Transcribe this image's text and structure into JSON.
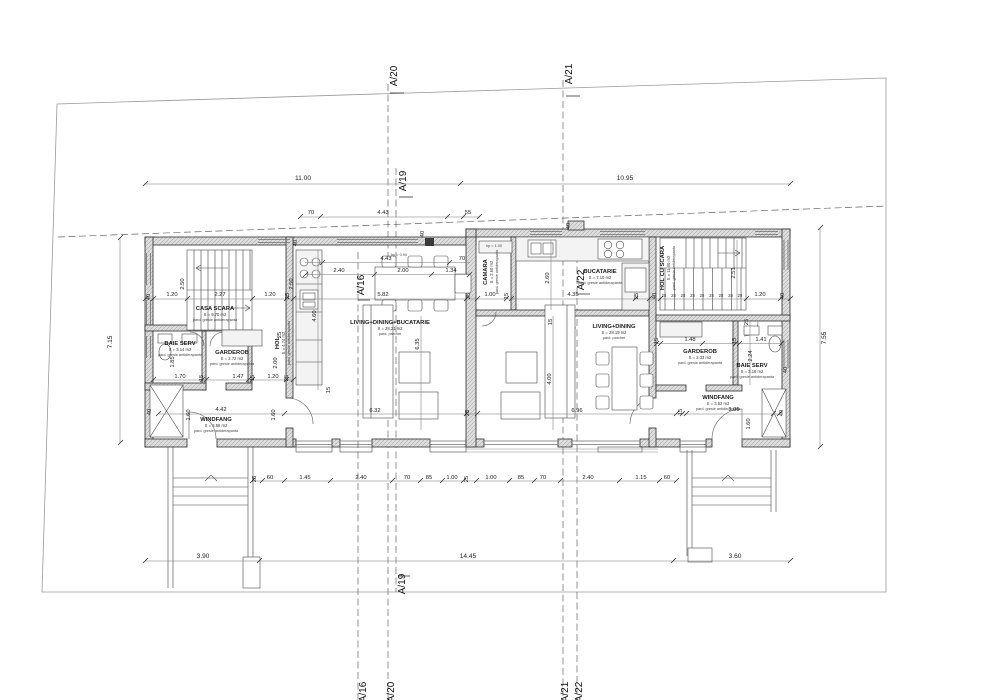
{
  "meta": {
    "drawing": "ground floor plan - duplex house"
  },
  "sections": {
    "a16": "A/16",
    "a19": "A/19",
    "a20": "A/20",
    "a21": "A/21",
    "a22": "A/22"
  },
  "rooms": {
    "casa_scara": {
      "name": "CASA SCARA",
      "area": "S = 9.70 m2",
      "finish": "pard. gresie antiderapanta"
    },
    "baie_serv_left": {
      "name": "BAIE SERV",
      "area": "S = 3.14 m2",
      "finish": "pard. gresie antiderapanta"
    },
    "garderob_left": {
      "name": "GARDEROB",
      "area": "S = 2.72 m2",
      "finish": "pard. gresie antiderapanta"
    },
    "hol_left": {
      "name": "HOL",
      "area": "S = 4.74 m2",
      "finish": "pard. gresie antiderapanta"
    },
    "windfang_left": {
      "name": "WINDFANG",
      "area": "S = 3.56 m2",
      "finish": "pard. gresie antiderapanta"
    },
    "living_left": {
      "name": "LIVING+DINING+BUCATARIE",
      "area": "S = 28.21 m2",
      "finish": "pard. parchet"
    },
    "camara": {
      "name": "CAMARA",
      "area": "S = 2.60 m2",
      "finish": "pard. gresie antiderapanta"
    },
    "bucatarie": {
      "name": "BUCATARIE",
      "area": "S = 7.10 m2",
      "finish": "pard. gresie antiderapanta"
    },
    "hol_cu_scara": {
      "name": "HOL CU SCARA",
      "area": "S = 11.00 m2",
      "finish": "pard. gresie antiderapanta"
    },
    "living_right": {
      "name": "LIVING+DINING",
      "area": "S = 28.19 m2",
      "finish": "pard. parchet"
    },
    "garderob_right": {
      "name": "GARDEROB",
      "area": "S = 2.33 m2",
      "finish": "pard. gresie antiderapanta"
    },
    "baie_serv_right": {
      "name": "BAIE SERV",
      "area": "S = 3.16 m2",
      "finish": "pard. gresie antiderapanta"
    },
    "windfang_right": {
      "name": "WINDFANG",
      "area": "S = 3.52 m2",
      "finish": "pard. gresie antiderapanta"
    }
  },
  "notes": {
    "hp090": "hp = 0.90",
    "hp100": "hp = 1.00"
  },
  "site": {
    "top_left": "11.00",
    "top_right": "10.95",
    "side_left": "7.15",
    "side_right": "7.55",
    "bottom_left": "3.90",
    "bottom_mid": "14.45",
    "bottom_right": "3.60"
  },
  "top_chain": {
    "a": "70",
    "b": "4.43",
    "c": "55"
  },
  "upper_chain": {
    "a": "4.43",
    "b": "70",
    "c": "2.40",
    "d": "2.00",
    "e": "1.34"
  },
  "main_chain": {
    "a": "40",
    "b": "1.20",
    "c": "2.27",
    "d": "1.20",
    "e": "25",
    "f": "5.82",
    "g": "25",
    "h": "1.00",
    "i": "15",
    "j": "4.35",
    "k": "25",
    "l": "40",
    "m": "1.20",
    "n": "40",
    "tread": "28"
  },
  "left_core": {
    "h_upper_a": "2.50",
    "h_upper_b": "2.50",
    "w25": "25",
    "h_mid_a": "1.85",
    "h_mid_b": "2.00",
    "row_a": "1.70",
    "row_b": "15",
    "row_c": "1.47",
    "row_d": "15",
    "row_e": "1.20",
    "row_f": "25",
    "w40": "40",
    "h_wf_a": "1.60",
    "wf_w": "4.42",
    "h_wf_b": "1.60",
    "k_depth": "4.60",
    "w15": "15"
  },
  "living_dims": {
    "l_depth": "6.35",
    "l_width": "6.32",
    "p25": "25",
    "r_depth": "4.00",
    "r_width": "6.96",
    "p15": "15",
    "buc_h": "2.60",
    "st_h": "2.51"
  },
  "right_core": {
    "p25": "25",
    "row_a": "15",
    "row_b": "1.48",
    "row_c": "15",
    "row_d": "1.41",
    "bs_h": "2.24",
    "wf_a": "15",
    "wf_w": "3.05",
    "wf_h": "1.60",
    "w40a": "40",
    "w40b": "40"
  },
  "bottom_chain": {
    "a": "25",
    "b": "60",
    "c": "1.45",
    "d": "2.40",
    "e": "70",
    "f": "85",
    "g": "1.00",
    "h": "25",
    "i": "1.00",
    "j": "85",
    "k": "70",
    "l": "2.40",
    "m": "1.15",
    "n": "60"
  },
  "wall_marks": {
    "w40": "40"
  }
}
